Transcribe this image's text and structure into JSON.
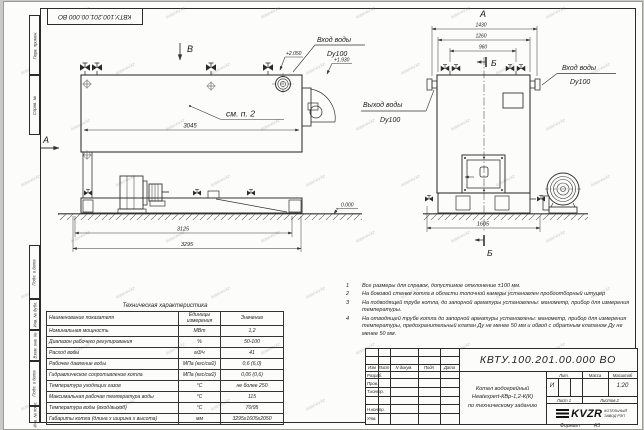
{
  "page": {
    "stamp_top": "КВТУ.100.201.00.000 ВО",
    "format_label": "Формат",
    "format_value": "А3",
    "watermark": "kotel-kv.kz"
  },
  "margin": {
    "items": [
      "Перв. примен.",
      "Справ. №",
      "Подп. и дата",
      "Инв. № дубл.",
      "Взам. инв. №",
      "Подп. и дата",
      "Инв. № подл."
    ]
  },
  "drawing": {
    "views": {
      "top_arrow": "В",
      "side_arrow": "А",
      "front_label": "А",
      "section_label": "Б"
    },
    "callout_see_note": "см. п. 2",
    "water_inlet": "Вход воды",
    "water_inlet_dn": "Dy100",
    "water_outlet": "Выход воды",
    "water_outlet_dn": "Dy100",
    "elev_top1": "+2.050",
    "elev_top2": "+1.930",
    "elev_ground": "0.000",
    "dim_body_length": "3045",
    "dim_length_mid": "3125",
    "dim_length_total": "3295",
    "dim_width_total": "1430",
    "dim_width_body": "1260",
    "dim_width_pipes": "960",
    "dim_width_base": "1605"
  },
  "notes": {
    "items": [
      {
        "num": "1",
        "text": "Все размеры для справок, допустимое отклонение ±100 мм."
      },
      {
        "num": "2",
        "text": "На боковой стенке котла в области топочной камеры установлен пробоотборный штуцер"
      },
      {
        "num": "3",
        "text": "На  подводящей трубе котла, до запорной арматуры установлены: манометр, прибор для измерения температуры."
      },
      {
        "num": "4",
        "text": "На отводящей трубе котла до запорной арматуры установлены: манометр, прибор для измерения температуры, предохранительный клапан  Ду не менее 50 мм и обвод с обратным клапаном  Ду не менее 50 мм."
      }
    ]
  },
  "tech_table": {
    "title": "Техническая характеристика",
    "headers": {
      "name": "Наименование показателя",
      "units": "Единицы измерения",
      "value": "Значение"
    },
    "rows": [
      {
        "name": "Номинальная мощность",
        "units": "МВт",
        "value": "1,2"
      },
      {
        "name": "Диапазон рабочего регулирования",
        "units": "%",
        "value": "50-100"
      },
      {
        "name": "Расход воды",
        "units": "м3/ч",
        "value": "41"
      },
      {
        "name": "Рабочее давление воды",
        "units": "МПа (кгс/см2)",
        "value": "0,6 (6,0)"
      },
      {
        "name": "Гидравлическое сопротивление котла",
        "units": "МПа (кгс/см2)",
        "value": "0,06 (0,6)"
      },
      {
        "name": "Температура уходящих газов",
        "units": "°С",
        "value": "не более 250"
      },
      {
        "name": "Максимальная рабочая температура воды",
        "units": "°С",
        "value": "115"
      },
      {
        "name": "Температура воды (вход/выход)",
        "units": "°С",
        "value": "70/95"
      },
      {
        "name": "Габариты котла (длина х ширина х высота)",
        "units": "мм",
        "value": "3295х1605х2050"
      }
    ]
  },
  "title_block": {
    "doc_number": "КВТУ.100.201.00.000  ВО",
    "rev_header": {
      "izm": "Изм",
      "list": "Лист",
      "docnum": "N докум.",
      "podp": "Подп",
      "data": "Дата"
    },
    "sign_rows": [
      "Разраб.",
      "Пров.",
      "Т.контр.",
      "",
      "Н.контр.",
      "Утв."
    ],
    "name_lines": [
      "Котел водогрейный",
      "Heatexpert-КВр-1,2-К(К)",
      "по техническому заданию"
    ],
    "lit_header": "Лит.",
    "lit_value": "И",
    "mass_header": "Масса",
    "scale_header": "Масштаб",
    "scale_value": "1:20",
    "sheet_cell": "Лист  1",
    "sheets_cell": "Листов  2",
    "logo_text": "KVZR",
    "company_line1": "КОТЕЛЬНЫЙ",
    "company_line2": "ЗАВОД РЭП"
  }
}
